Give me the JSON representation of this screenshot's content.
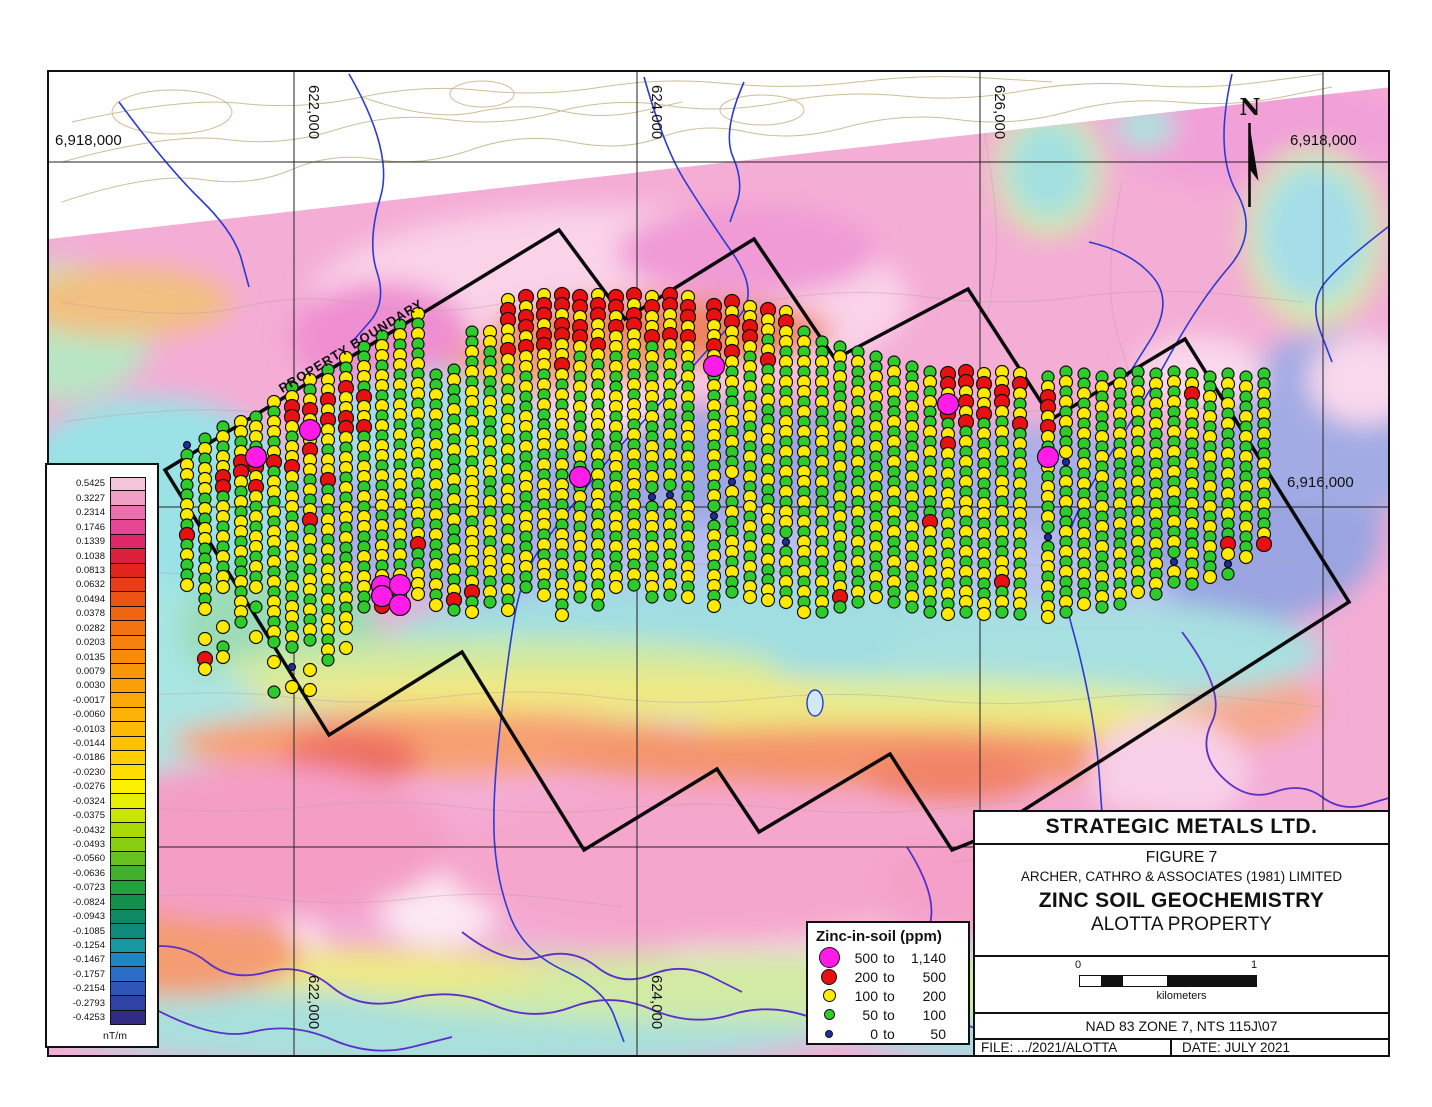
{
  "map": {
    "labels": {
      "top_left_northing": "6,918,000",
      "top_right_northing": "6,918,000",
      "mid_right_northing": "6,916,000",
      "easting_1": "622,000",
      "easting_2": "624,000",
      "easting_3": "626,000",
      "easting_1_bottom": "622,000",
      "easting_2_bottom": "624,000",
      "north": "N",
      "boundary_label": "PROPERTY BOUNDARY"
    },
    "gridlines": {
      "vertical_x": [
        292,
        635,
        978,
        1321
      ],
      "horizontal_y": [
        160,
        505,
        845
      ]
    },
    "boundary_points": [
      [
        163,
        468
      ],
      [
        557,
        228
      ],
      [
        623,
        317
      ],
      [
        752,
        237
      ],
      [
        833,
        357
      ],
      [
        966,
        287
      ],
      [
        1050,
        417
      ],
      [
        1183,
        337
      ],
      [
        1347,
        600
      ],
      [
        975,
        838
      ],
      [
        950,
        848
      ],
      [
        888,
        752
      ],
      [
        757,
        830
      ],
      [
        715,
        767
      ],
      [
        582,
        848
      ],
      [
        460,
        650
      ],
      [
        327,
        733
      ]
    ],
    "dot_style": {
      "G": {
        "color": "#2ecc2a",
        "r": 6
      },
      "Y": {
        "color": "#ffea00",
        "r": 6.5
      },
      "R": {
        "color": "#e81010",
        "r": 7.5
      },
      "M": {
        "color": "#ff1ce8",
        "r": 10.5
      },
      "B": {
        "color": "#1b2ea0",
        "r": 3.5
      }
    },
    "sample_lines": [
      [
        185,
        443,
        "BGYYGGYYGRGYGGY"
      ],
      [
        203,
        437,
        "GYGYYYGYGYYGGYGYGY..Y.RY"
      ],
      [
        221,
        425,
        "GYGYYRRGYYGYGYGYY...Y.GY"
      ],
      [
        239,
        420,
        "YYGYRRYGYGYYGYGGYGYYG"
      ],
      [
        254,
        415,
        "GYYGMRYRYGYGYYGYGY.G..Y"
      ],
      [
        272,
        400,
        "YGYYGYRGYYGYGYYGYGYGYYGYG.Y..G"
      ],
      [
        290,
        385,
        "GYRRYGYYRYGYYGYGYYGGYGYYGYG.B.Y"
      ],
      [
        308,
        378,
        "YGYRYMYRYYGYGYRGYGYGYYGYGYG..Y.Y"
      ],
      [
        326,
        368,
        "GYYRYRYYGYYRGYGYYGYGYYGYGYYGYG"
      ],
      [
        344,
        356,
        "YGYRYYRRYGYYGYGYYGYGGYYGYGYY.Y"
      ],
      [
        362,
        345,
        "GGYYGRYYRGYGYYGYGYYGGYGYYGG"
      ],
      [
        380,
        334,
        "GYYGYYGYGYGYYGYGYYGYGYYGYMMR"
      ],
      [
        398,
        323,
        "GYGYYGYGYYGYGYGYYGYGYYGYGYMYM"
      ],
      [
        416,
        312,
        "YGYGGYGYYGYGGYYGYGGYYGYRGGYYY"
      ],
      [
        434,
        373,
        "GGYGYGGYGYGYGGYGYGGYGYGY"
      ],
      [
        452,
        368,
        "GYGGYGYGYGGYGYGYGGYGYGYRG"
      ],
      [
        470,
        330,
        "GGYGYGYYGYGYYGYYYYYGYYYYGYRGY"
      ],
      [
        488,
        330,
        "YYGGYGGYYGGYGYYGGYGYYGYYYGYG"
      ],
      [
        506,
        298,
        "YRRYYRYGYGYGYYGYGYGYYGYGYGYYGYGY"
      ],
      [
        524,
        295,
        "RYRRYRYYGYGGYYGYGGYYGGYYGGYYGG"
      ],
      [
        542,
        293,
        "YRRYRRYYGYGYGGYYGYGYYGYYGYGYYGY"
      ],
      [
        560,
        293,
        "RRYRRYYRYGYGYYGYGYGYYGYGYYGYGYYGY"
      ],
      [
        578,
        295,
        "RRYRRYGYGYGYGGYGYGMGYGYGYYGYGYG"
      ],
      [
        596,
        293,
        "YRRYYRYGYGYGYYGGYGYGYYGYGYGYYGYG"
      ],
      [
        614,
        295,
        "RRYRYYGYGGYYGYGGYYGYGGYYGYGGYY"
      ],
      [
        632,
        293,
        "RYRRYYGYGYGYYGYGYGYYGYGYGYYGYG"
      ],
      [
        650,
        295,
        "YRYYRGYGGYYGYGGYYGYGBGYYGYGGYYG"
      ],
      [
        668,
        293,
        "RRYYRYGYGYGYGGYGYGYGBYGYGYGYGYG"
      ],
      [
        686,
        295,
        "YRRYRYYGYGYGGYYGYGYGGYYGYGGYYGY"
      ],
      [
        712,
        304,
        "RRYYRYMGYGYGYYGYGYGYGBGYGYGYYGY"
      ],
      [
        730,
        300,
        "RYRYYRYGYGGYYGYGGYBYGYGGYYGYGG"
      ],
      [
        748,
        305,
        "YYRRYGYGYGYYGYGYGYGYYGYGYGYGYY"
      ],
      [
        766,
        308,
        "RYYGYRGYGYGGYYGYGYGGYYGYGYGGYY"
      ],
      [
        784,
        310,
        "YRYYGYGYGYGYYGYGYGYGYYGBGYGYGY"
      ],
      [
        802,
        330,
        "GYGYGYYGYGYGYGYYGYGYGYYGYGYGY"
      ],
      [
        820,
        340,
        "GGYGYGYGGYYGYGYGGYGYGYGGYGYG"
      ],
      [
        838,
        345,
        "GYGYGGYGYGYGYGGYGYGYGGYGYRG"
      ],
      [
        856,
        350,
        "GYGGYGYGGYGYGGYGYGGYGYGGYG"
      ],
      [
        874,
        355,
        "GGYGYGGYGYGGYGYGGYGYGGYGY"
      ],
      [
        892,
        360,
        "GYGYGGYGYGYGGYGYGYGGYGYGG"
      ],
      [
        910,
        365,
        "GGYGYGYGGYGYGYGGYGYGYGGYG"
      ],
      [
        928,
        370,
        "GYGYGGYGYGYGYGGRYGYGYGYGG"
      ],
      [
        946,
        372,
        "RRYMRGYRYGYGYYGYGYGYYGYGY"
      ],
      [
        964,
        370,
        "RRYRYRGYGYGYGYYGYGYGYGYYG"
      ],
      [
        982,
        372,
        "YRYYRGYGYGYGGYYGYGYGYGGYY"
      ],
      [
        1000,
        370,
        "YYRRYGYGYGGYYGYGYGGYYRGYG"
      ],
      [
        1018,
        372,
        "YRYGYRGYGYGYGYYGYGYGYGYYG"
      ],
      [
        1046,
        375,
        "GYRRYRYGMYGYYGYGBGYYGYGYY"
      ],
      [
        1064,
        370,
        "GYGYGYGGYBGYGYGGYGYGYGGYG"
      ],
      [
        1082,
        372,
        "GGYGYGYGGYGYGYGGYGYGYGGY"
      ],
      [
        1100,
        375,
        "GYGYGGYGYGYGGYGYGYGGYGYG"
      ],
      [
        1118,
        372,
        "GYGGYGYGYGGYGYGYGGYGYGYG"
      ],
      [
        1136,
        370,
        "GGYGYGYGYGGYGYGYGYGGYGY"
      ],
      [
        1154,
        372,
        "GYGYGYGGYGYGYGYGGYGYGYG"
      ],
      [
        1172,
        370,
        "GYGYGGYGYGYGYGGYGYGBYG"
      ],
      [
        1190,
        372,
        "GYRGYGYGGYGYGYGYGGYGYG"
      ],
      [
        1208,
        375,
        "GGYGYGYGYGGYGYGYGYGGY"
      ],
      [
        1226,
        372,
        "GYGYGYGGYGYGYGYGGRYBG"
      ],
      [
        1244,
        375,
        "GYGGYGYGYGGYGYGYGGY"
      ],
      [
        1262,
        372,
        "GGYGYGYGGYGYGYGGYR"
      ]
    ]
  },
  "colorbar": {
    "unit": "nT/m",
    "values": [
      "0.5425",
      "0.3227",
      "0.2314",
      "0.1746",
      "0.1339",
      "0.1038",
      "0.0813",
      "0.0632",
      "0.0494",
      "0.0378",
      "0.0282",
      "0.0203",
      "0.0135",
      "0.0079",
      "0.0030",
      "-0.0017",
      "-0.0060",
      "-0.0103",
      "-0.0144",
      "-0.0186",
      "-0.0230",
      "-0.0276",
      "-0.0324",
      "-0.0375",
      "-0.0432",
      "-0.0493",
      "-0.0560",
      "-0.0636",
      "-0.0723",
      "-0.0824",
      "-0.0943",
      "-0.1085",
      "-0.1254",
      "-0.1467",
      "-0.1757",
      "-0.2154",
      "-0.2793",
      "-0.4253"
    ],
    "colors": [
      "#f6c4da",
      "#f29fc6",
      "#ec70ad",
      "#e54694",
      "#e02568",
      "#dc1f3a",
      "#e0261c",
      "#e63f16",
      "#ec5414",
      "#f06512",
      "#f37310",
      "#f5800e",
      "#f78c0c",
      "#f8960a",
      "#fa9f08",
      "#fba807",
      "#fcb106",
      "#fdba05",
      "#fdc303",
      "#fece02",
      "#fedd01",
      "#fdf000",
      "#e9ef00",
      "#c9e600",
      "#a9da06",
      "#8ace12",
      "#68bf20",
      "#42b02c",
      "#24a13a",
      "#128f4a",
      "#0d8a62",
      "#0f8b7e",
      "#1697a2",
      "#1f86c0",
      "#2a6cc6",
      "#2f55b8",
      "#2f42a6",
      "#332a84"
    ]
  },
  "legend": {
    "title": "Zinc-in-soil (ppm)",
    "entries": [
      {
        "low": "500",
        "to": "to",
        "high": "1,140",
        "color": "#ff1ce8",
        "size": 21
      },
      {
        "low": "200",
        "to": "to",
        "high": "500",
        "color": "#e81010",
        "size": 16
      },
      {
        "low": "100",
        "to": "to",
        "high": "200",
        "color": "#ffea00",
        "size": 13
      },
      {
        "low": "50",
        "to": "to",
        "high": "100",
        "color": "#2ecc2a",
        "size": 11
      },
      {
        "low": "0",
        "to": "to",
        "high": "50",
        "color": "#1b2ea0",
        "size": 8
      }
    ]
  },
  "title_block": {
    "company": "STRATEGIC METALS LTD.",
    "figure": "FIGURE 7",
    "author": "ARCHER, CATHRO & ASSOCIATES (1981) LIMITED",
    "title": "ZINC SOIL GEOCHEMISTRY",
    "subtitle": "ALOTTA PROPERTY",
    "datum": "NAD 83 ZONE 7, NTS 115J\\07",
    "file": "FILE: .../2021/ALOTTA",
    "date": "DATE: JULY 2021",
    "scalebar": {
      "start": "0",
      "end": "1",
      "unit": "kilometers"
    }
  }
}
